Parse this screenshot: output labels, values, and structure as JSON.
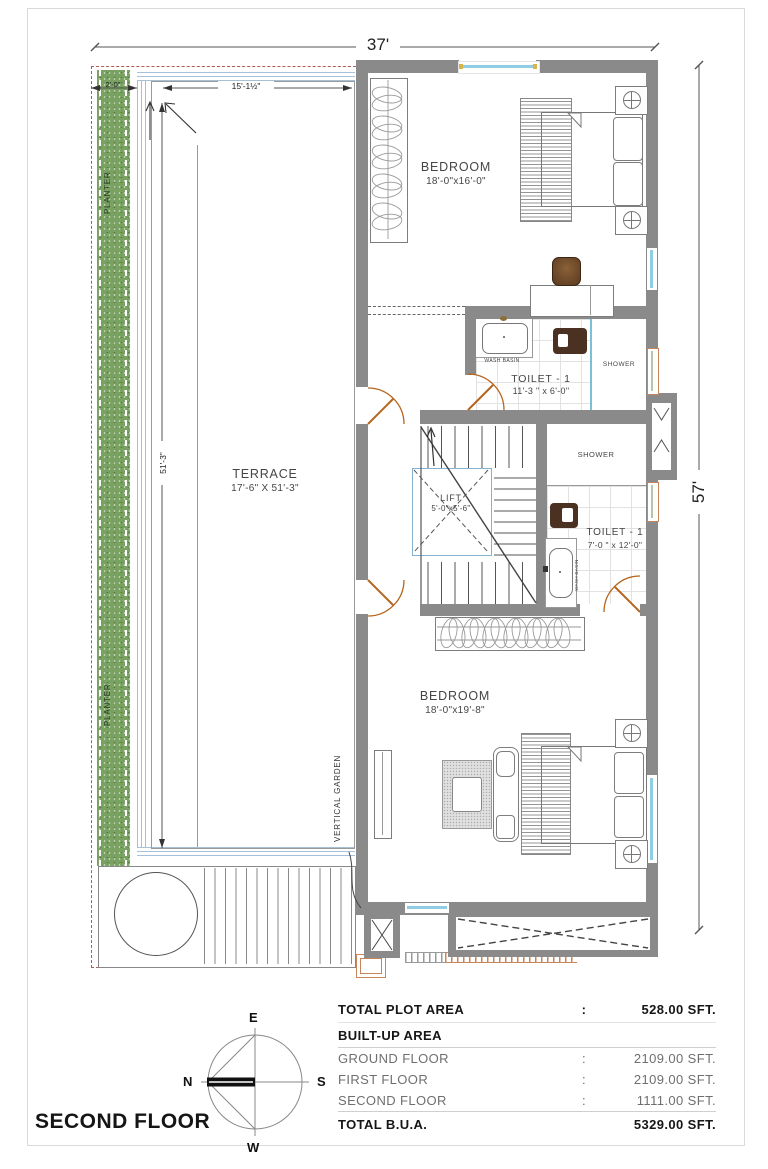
{
  "title": "SECOND FLOOR",
  "dims": {
    "width_total": "37'",
    "height_total": "57'",
    "terrace_len": "51'-3\"",
    "planter_w": "2'-0\"",
    "terrace_top_w": "15'-1½\""
  },
  "rooms": {
    "bedroom_top": {
      "name": "BEDROOM",
      "size": "18'-0\"x16'-0\""
    },
    "bedroom_bottom": {
      "name": "BEDROOM",
      "size": "18'-0\"x19'-8\""
    },
    "terrace": {
      "name": "TERRACE",
      "size": "17'-6\" X 51'-3\""
    },
    "toilet_top": {
      "name": "TOILET - 1",
      "size": "11'-3 \" x 6'-0\""
    },
    "toilet_bottom": {
      "name": "TOILET - 1",
      "size": "7'-0 \" x 12'-0\""
    },
    "lift": {
      "name": "LIFT",
      "size": "5'-0\"x5'-6\""
    },
    "shower_top": {
      "name": "SHOWER"
    },
    "shower_mid": {
      "name": "SHOWER"
    },
    "wash_basin_top": {
      "name": "WASH BASIN"
    },
    "wash_basin_bottom": {
      "name": "WASH BASIN"
    },
    "planter_top": {
      "name": "PLANTER"
    },
    "planter_bottom": {
      "name": "PLANTER"
    },
    "vertical_garden": {
      "name": "VERTICAL GARDEN"
    }
  },
  "area_table": {
    "rows": [
      {
        "label": "TOTAL PLOT AREA",
        "sep": ":",
        "value": "528.00 SFT."
      },
      {
        "label": "BUILT-UP AREA",
        "sep": "",
        "value": ""
      },
      {
        "label": "GROUND FLOOR",
        "sep": ":",
        "value": "2109.00 SFT."
      },
      {
        "label": "FIRST FLOOR",
        "sep": ":",
        "value": "2109.00 SFT."
      },
      {
        "label": "SECOND FLOOR",
        "sep": ":",
        "value": "1111.00 SFT."
      },
      {
        "label": "TOTAL B.U.A.",
        "sep": "",
        "value": "5329.00 SFT."
      }
    ]
  },
  "compass": {
    "top": "E",
    "right": "S",
    "left": "N",
    "bottom": "W"
  },
  "colors": {
    "wall": "#8a8a8a",
    "planter_green": "#79a161",
    "boundary_red": "#b25b50",
    "glass_blue": "#8fcde2",
    "door_orange": "#b5651d"
  }
}
